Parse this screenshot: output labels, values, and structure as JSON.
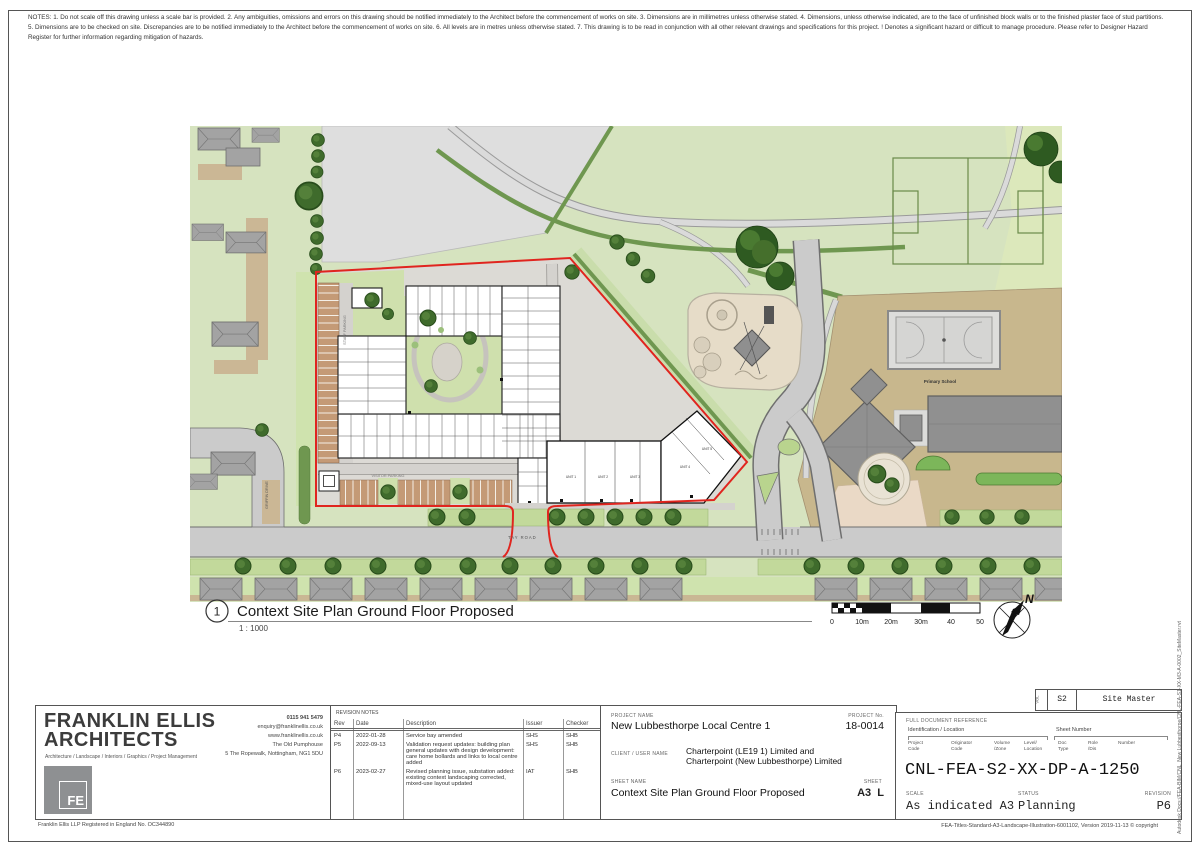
{
  "notes": "NOTES: 1. Do not scale off this drawing unless a scale bar is provided.  2. Any ambiguities, omissions and errors on this drawing should be notified immediately to the Architect before the commencement of works on site.  3. Dimensions are in millimetres unless otherwise stated.  4. Dimensions, unless otherwise indicated, are to the face of unfinished block walls or to the finished plaster face of stud partitions.  5. Dimensions are to be checked on site. Discrepancies are to be notified immediately to the Architect before the commencement of works on site.  6. All levels are in metres unless otherwise stated.  7. This drawing is to be read in conjunction with all other relevant drawings and specifications for this project.  ! Denotes a significant hazard or difficult to manage procedure. Please refer to Designer Hazard Register for further information regarding mitigation of hazards.",
  "drawing": {
    "view_number": "1",
    "title": "Context Site Plan Ground Floor Proposed",
    "scale_text": "1 : 1000",
    "scale_bar": [
      "0",
      "10m",
      "20m",
      "30m",
      "40",
      "50"
    ],
    "north": "N"
  },
  "plan": {
    "road_main": "TAY ROAD",
    "road_side": "GRIFFIN DRIVE",
    "staff_parking": "STAFF PARKING",
    "visitor_parking": "VISITOR PARKING",
    "school": "Primary School",
    "units": [
      "UNIT 1",
      "UNIT 2",
      "UNIT 3",
      "UNIT 4",
      "UNIT 5"
    ]
  },
  "title_block": {
    "architect": {
      "name_line1": "FRANKLIN ELLIS",
      "name_line2": "ARCHITECTS",
      "tagline": "Architecture / Landscape / Interiors / Graphics / Project Management",
      "phone": "0115 941 5479",
      "email": "enquiry@franklinellis.co.uk",
      "website": "www.franklinellis.co.uk",
      "address_line1": "The Old Pumphouse",
      "address_line2": "5 The Ropewalk, Nottingham, NG1 5DU",
      "logo_text": "FE",
      "registration": "Franklin Ellis LLP    Registered in England No. OC344890"
    },
    "revisions": {
      "heading": "REVISION NOTES",
      "columns": [
        "Rev",
        "Date",
        "Description",
        "Issuer",
        "Checker"
      ],
      "rows": [
        {
          "rev": "P4",
          "date": "2022-01-28",
          "description": "Service bay amended",
          "issuer": "SHS",
          "checker": "SHB"
        },
        {
          "rev": "P5",
          "date": "2022-09-13",
          "description": "Validation request updates: building plan general updates with design development: care home bollards and links to local centre added",
          "issuer": "SHS",
          "checker": "SHB"
        },
        {
          "rev": "P6",
          "date": "2023-02-27",
          "description": "Revised planning issue, substation added: existing context landscaping corrected, mixed-use layout updated",
          "issuer": "IAT",
          "checker": "SHB"
        }
      ]
    },
    "project": {
      "project_name_label": "PROJECT NAME",
      "project_name": "New Lubbesthorpe Local Centre 1",
      "project_no_label": "PROJECT No.",
      "project_no": "18-0014",
      "client_label": "CLIENT / USER NAME",
      "client_line1": "Charterpoint (LE19 1) Limited and",
      "client_line2": "Charterpoint (New  Lubbesthorpe) Limited",
      "sheet_name_label": "SHEET NAME",
      "sheet_name": "Context Site Plan Ground Floor Proposed",
      "sheet_label": "SHEET",
      "sheet": "A3  L"
    },
    "reference": {
      "vol_label": "VOL",
      "vol_value": "S2",
      "vol_name": "Site Master",
      "full_doc_label": "FULL DOCUMENT REFERENCE",
      "ident_label": "Identification / Location",
      "sheet_number_label": "Sheet Number",
      "col_labels": [
        "Project\nCode",
        "Originator\nCode",
        "Volume\n/Zone",
        "Level/\nLocation",
        "Doc\nType",
        "Role\n/Dis",
        "Number"
      ],
      "doc_ref": "CNL-FEA-S2-XX-DP-A-1250",
      "scale_label": "SCALE",
      "scale_value": "As indicated A3",
      "status_label": "STATUS",
      "status_value": "Planning",
      "revision_label": "REVISION",
      "revision_value": "P6"
    },
    "side_text": "Autodesk Docs://FEA-BIM/CNL_New Lubbesthorpe/CNL-FEA-S1-XX-M3-A-0002_SiteMaster.rvt",
    "footer_right": "FEA-Titles-Standard-A3-Landscape-Illustration-6001102, Version 2019-11-13    © copyright"
  },
  "colors": {
    "boundary_red": "#e0251f",
    "grass_green": "#d6e3bf",
    "road_grey": "#cbcbcb",
    "parking_tan": "#c49a76",
    "school_ground_tan": "#c8b78d",
    "tree_green": "#3f6b2c",
    "building_grey": "#909090"
  }
}
